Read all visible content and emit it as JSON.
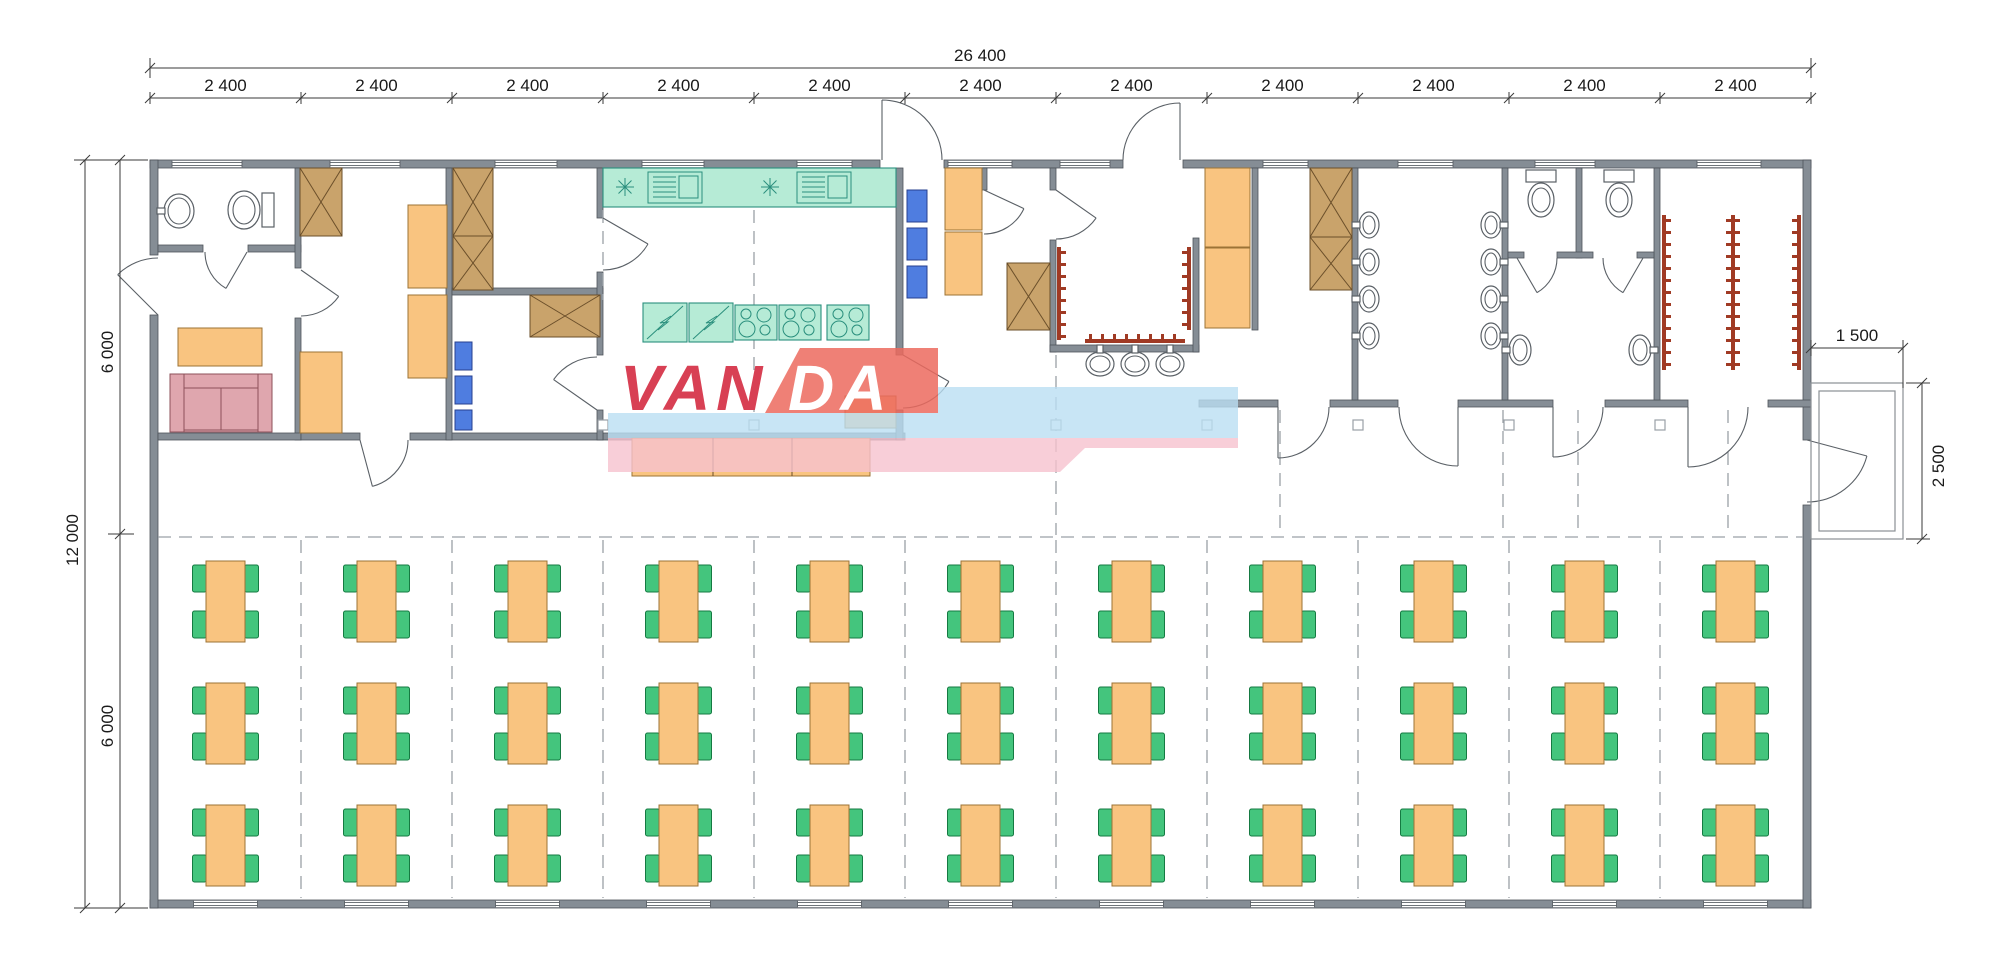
{
  "dimensions": {
    "top_total": "26 400",
    "top_segments": [
      "2 400",
      "2 400",
      "2 400",
      "2 400",
      "2 400",
      "2 400",
      "2 400",
      "2 400",
      "2 400",
      "2 400",
      "2 400"
    ],
    "left_total": "12 000",
    "left_top_half": "6 000",
    "left_bottom_half": "6 000",
    "right_porch_width": "1 500",
    "right_porch_height": "2 500"
  },
  "watermark": {
    "text": "VANDA",
    "left_part": "VAN",
    "right_part": "DA",
    "red": "#d84054",
    "white": "#ffffff",
    "blue_band": "#badff2",
    "pink_band": "#f6c2ce",
    "salmon_band": "#ec6a5e"
  },
  "palette": {
    "wall": "#858d95",
    "wall_edge": "#4e545a",
    "furniture_orange": "#f9c480",
    "furniture_orange_edge": "#9c7336",
    "wardrobe_tan": "#c9a36b",
    "wardrobe_edge": "#6b4f2a",
    "kitchen_mint": "#b6ebd6",
    "kitchen_edge": "#2a8f7d",
    "chair_green": "#44c57d",
    "chair_edge": "#157a42",
    "stool_blue": "#4f7de0",
    "stool_edge": "#27408f",
    "sofa_pink": "#dfa6ae",
    "sofa_edge": "#8c5059",
    "hooks_red": "#a03a24",
    "fixture_line": "#5a6066",
    "dashed_line": "#9aa0a6",
    "dim_line": "#3a3a3a",
    "porch_line": "#8a8f94",
    "text": "#1a1a1a"
  },
  "layout_counts": {
    "modules": 11,
    "table_columns": 11,
    "table_rows": 3,
    "chairs_per_table": 4
  }
}
